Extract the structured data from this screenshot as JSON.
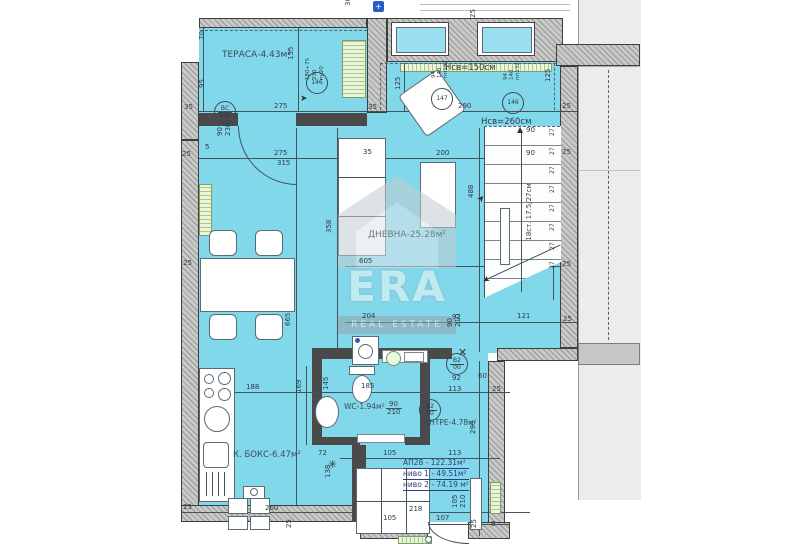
{
  "plan": {
    "rooms": {
      "terrace": "ТЕРАСА-4.43м²",
      "living": "ДНЕВНА-25.28м²",
      "wc": "WC-1.94м²",
      "antre": "АНТРЕ-4.78м²",
      "kitchen": "К. БОКС-6.47м²",
      "h150": "Нсв=150см",
      "h260": "Нсв=260см",
      "stairs": "18ст. 17.5/27см"
    },
    "apartment": {
      "line1": "АП28 - 122.31м²",
      "line2": "ниво 1 - 49.51м²",
      "line3": "ниво 2 - 74.19 м²"
    },
    "watermark": {
      "name": "ERA",
      "sub": "REAL ESTATE"
    },
    "colors": {
      "room": "#82d8eb",
      "wall": "#c9c9c9",
      "radiator": "#abc98d",
      "accent": "#2c3e7a"
    },
    "dims": [
      [
        "30",
        345,
        6,
        -90
      ],
      [
        "25",
        470,
        18,
        -90
      ],
      [
        "70",
        199,
        40,
        -90
      ],
      [
        "95",
        199,
        88,
        -90
      ],
      [
        "155",
        288,
        60,
        -90
      ],
      [
        "35",
        184,
        104
      ],
      [
        "275",
        274,
        103
      ],
      [
        "35",
        368,
        104
      ],
      [
        "125",
        395,
        90,
        -90
      ],
      [
        "125",
        545,
        82,
        -90
      ],
      [
        "290",
        458,
        103
      ],
      [
        "25",
        562,
        103
      ],
      [
        "90",
        217,
        136,
        -90
      ],
      [
        "230",
        225,
        136,
        -90
      ],
      [
        "5",
        205,
        144
      ],
      [
        "25",
        182,
        151
      ],
      [
        "275",
        274,
        150
      ],
      [
        "315",
        277,
        160
      ],
      [
        "35",
        363,
        149
      ],
      [
        "200",
        436,
        150
      ],
      [
        "180+75",
        305,
        80,
        -90,
        5.5
      ],
      [
        "230",
        312,
        80,
        -90,
        5.5
      ],
      [
        "пу20",
        319,
        80,
        -90,
        5.5
      ],
      [
        "94",
        431,
        78,
        -90,
        5.5
      ],
      [
        "140",
        437,
        78,
        -90,
        5.5
      ],
      [
        "пп192",
        443,
        78,
        -90,
        5.5
      ],
      [
        "94",
        503,
        80,
        -90,
        5.5
      ],
      [
        "140",
        509,
        80,
        -90,
        5.5
      ],
      [
        "пп132",
        515,
        80,
        -90,
        5.5
      ],
      [
        "90",
        526,
        127
      ],
      [
        "90",
        526,
        150
      ],
      [
        "25",
        562,
        149
      ],
      [
        "25",
        562,
        261
      ],
      [
        "27",
        549,
        136,
        -90,
        6
      ],
      [
        "27",
        549,
        155,
        -90,
        6
      ],
      [
        "27",
        549,
        174,
        -90,
        6
      ],
      [
        "27",
        549,
        193,
        -90,
        6
      ],
      [
        "27",
        549,
        212,
        -90,
        6
      ],
      [
        "27",
        549,
        231,
        -90,
        6
      ],
      [
        "27",
        549,
        250,
        -90,
        6
      ],
      [
        "27",
        549,
        269,
        -90,
        6
      ],
      [
        "121",
        517,
        313
      ],
      [
        "25",
        563,
        316
      ],
      [
        "488",
        468,
        198,
        -90
      ],
      [
        "358",
        326,
        233,
        -90
      ],
      [
        "605",
        359,
        258
      ],
      [
        "665",
        285,
        326,
        -90
      ],
      [
        "204",
        362,
        313
      ],
      [
        "92",
        452,
        314
      ],
      [
        "90",
        447,
        327,
        -90
      ],
      [
        "210",
        455,
        327,
        -90
      ],
      [
        "188",
        246,
        384
      ],
      [
        "169",
        296,
        393,
        -90
      ],
      [
        "145",
        323,
        390,
        -90
      ],
      [
        "185",
        361,
        383
      ],
      [
        "92",
        452,
        375
      ],
      [
        "113",
        448,
        386
      ],
      [
        "60",
        478,
        373
      ],
      [
        "25",
        492,
        386
      ],
      [
        "90",
        389,
        401
      ],
      [
        "210",
        387,
        409
      ],
      [
        "72",
        318,
        450
      ],
      [
        "105",
        383,
        450
      ],
      [
        "113",
        448,
        450
      ],
      [
        "290",
        470,
        434,
        -90
      ],
      [
        "138",
        325,
        478,
        -90
      ],
      [
        "25",
        183,
        504
      ],
      [
        "260",
        265,
        505
      ],
      [
        "25",
        286,
        528,
        -90
      ],
      [
        "218",
        409,
        506
      ],
      [
        "107",
        436,
        515
      ],
      [
        "105",
        383,
        515
      ],
      [
        "105",
        452,
        508,
        -90
      ],
      [
        "210",
        460,
        508,
        -90
      ],
      [
        "25",
        471,
        528,
        -90
      ],
      [
        "6",
        491,
        521
      ],
      [
        "25",
        183,
        260
      ]
    ],
    "markers": [
      [
        "ВС",
        "148",
        214,
        101
      ],
      [
        "146",
        "",
        306,
        72
      ],
      [
        "147",
        "",
        431,
        88
      ],
      [
        "146",
        "",
        502,
        92
      ],
      [
        "В2",
        "00",
        419,
        399
      ],
      [
        "В2",
        "00",
        446,
        353
      ]
    ]
  }
}
